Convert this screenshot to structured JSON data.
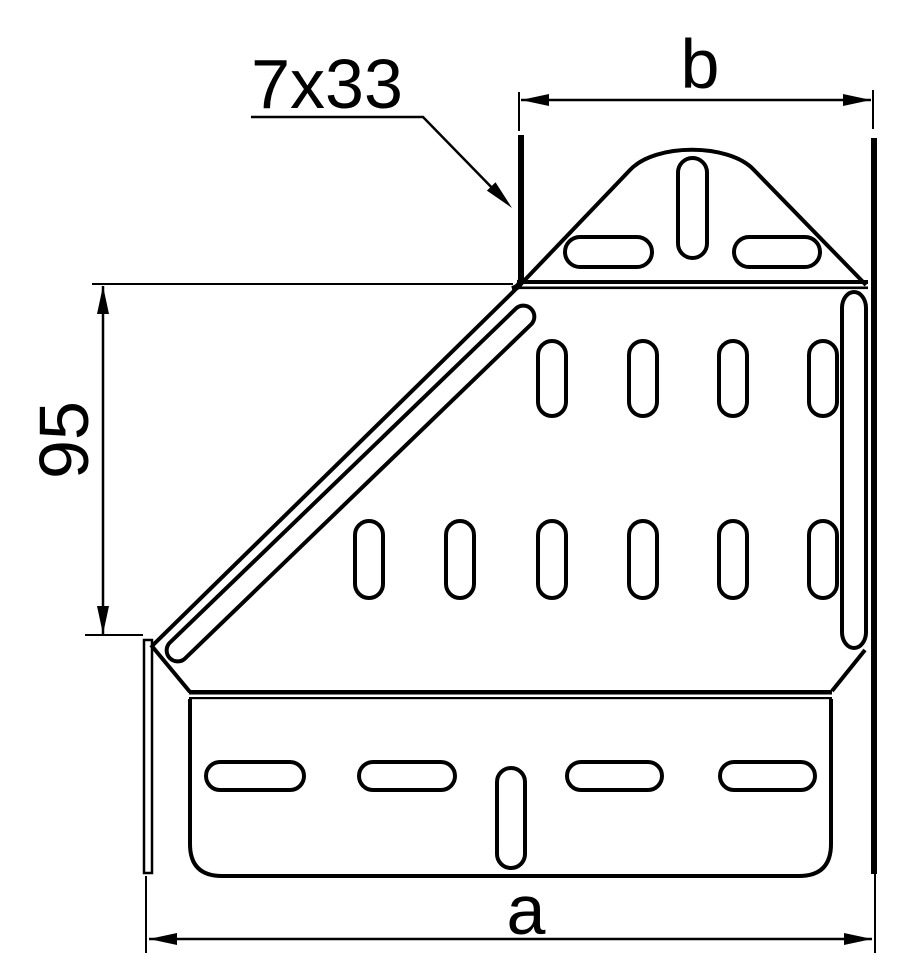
{
  "figure": {
    "type": "technical-drawing",
    "subject": "cable-tray-left-hand-reducer-plan-view",
    "background_color": "#ffffff",
    "stroke_color": "#000000"
  },
  "labels": {
    "slot_callout": "7x33",
    "dim_top_width": "b",
    "dim_left_height": "95",
    "dim_bottom_width": "a"
  }
}
